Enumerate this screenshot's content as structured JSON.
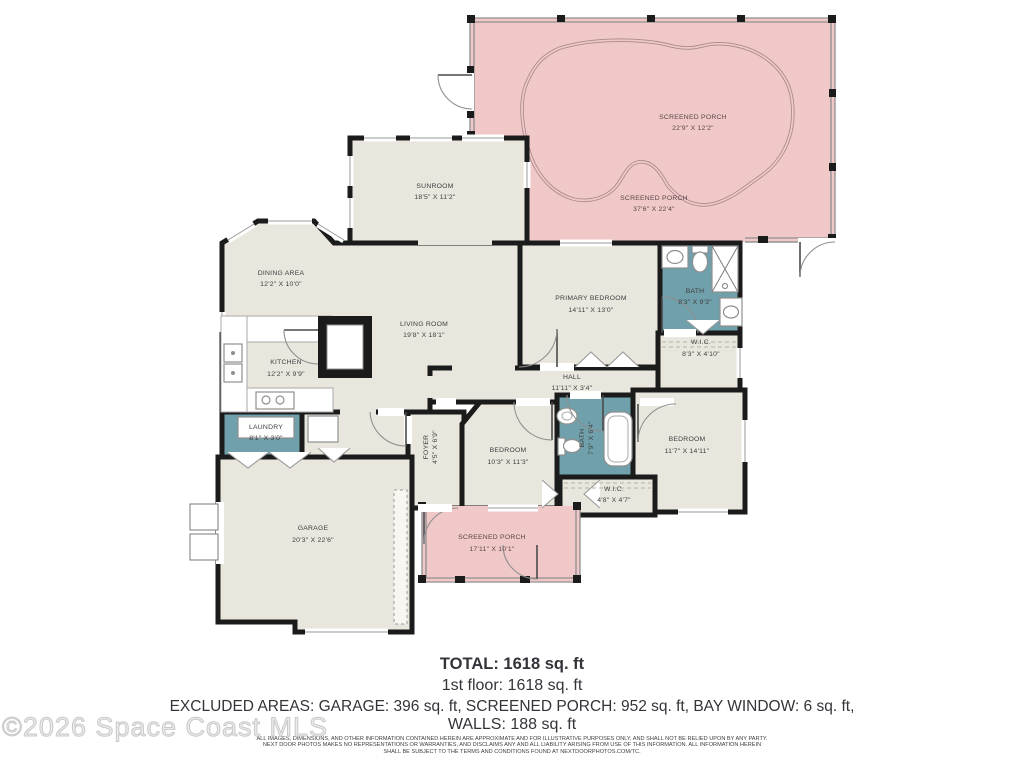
{
  "watermark": "©2026 Space Coast MLS",
  "summary": {
    "total": "TOTAL: 1618 sq. ft",
    "first_floor": "1st floor: 1618 sq. ft",
    "excluded": "EXCLUDED AREAS: GARAGE: 396 sq. ft, SCREENED PORCH: 952 sq. ft, BAY WINDOW: 6 sq. ft,",
    "walls": "WALLS: 188 sq. ft"
  },
  "disclaimer": {
    "line1": "ALL IMAGES, DIMENSIONS, AND OTHER INFORMATION CONTAINED HEREIN ARE APPROXIMATE AND FOR ILLUSTRATIVE PURPOSES ONLY, AND SHALL NOT BE RELIED UPON BY ANY PARTY.",
    "line2": "NEXT DOOR PHOTOS MAKES NO REPRESENTATIONS OR WARRANTIES, AND DISCLAIMS ANY AND ALL LIABILITY ARISING FROM USE OF THIS INFORMATION. ALL INFORMATION HEREIN",
    "line3": "SHALL BE SUBJECT TO THE TERMS AND CONDITIONS FOUND AT NEXTDOORPHOTOS.COM/TC."
  },
  "rooms": {
    "screened_porch_pool": {
      "name": "SCREENED PORCH",
      "dims": "22'9\" X 12'2\""
    },
    "screened_porch_top": {
      "name": "SCREENED PORCH",
      "dims": "37'6\" X 22'4\""
    },
    "sunroom": {
      "name": "SUNROOM",
      "dims": "18'5\" X 11'2\""
    },
    "dining": {
      "name": "DINING AREA",
      "dims": "12'2\" X 10'0\""
    },
    "living": {
      "name": "LIVING ROOM",
      "dims": "19'8\" X 18'1\""
    },
    "kitchen": {
      "name": "KITCHEN",
      "dims": "12'2\" X 9'9\""
    },
    "primary_bedroom": {
      "name": "PRIMARY BEDROOM",
      "dims": "14'11\" X 13'0\""
    },
    "bath_primary": {
      "name": "BATH",
      "dims": "8'3\" X 9'3\""
    },
    "wic_primary": {
      "name": "W.I.C.",
      "dims": "8'3\" X 4'10\""
    },
    "hall": {
      "name": "HALL",
      "dims": "11'11\" X 3'4\""
    },
    "laundry": {
      "name": "LAUNDRY",
      "dims": "8'1\" X 3'0\""
    },
    "foyer": {
      "name": "FOYER",
      "dims": "4'5\" X 6'9\""
    },
    "bedroom2": {
      "name": "BEDROOM",
      "dims": "10'3\" X 11'3\""
    },
    "bath2": {
      "name": "BATH",
      "dims": "7'9\" X 6'4\""
    },
    "bedroom3": {
      "name": "BEDROOM",
      "dims": "11'7\" X 14'11\""
    },
    "wic2": {
      "name": "W.I.C.",
      "dims": "4'8\" X 4'7\""
    },
    "garage": {
      "name": "GARAGE",
      "dims": "20'3\" X 22'6\""
    },
    "screened_porch_front": {
      "name": "SCREENED PORCH",
      "dims": "17'11\" X 10'1\""
    }
  },
  "colors": {
    "wall": "#1b1b1b",
    "room_fill": "#E9E6DD",
    "wet_room_fill": "#6FA0AB",
    "porch_fill": "#F0C8C8",
    "screen_line": "#8f8f8f"
  }
}
